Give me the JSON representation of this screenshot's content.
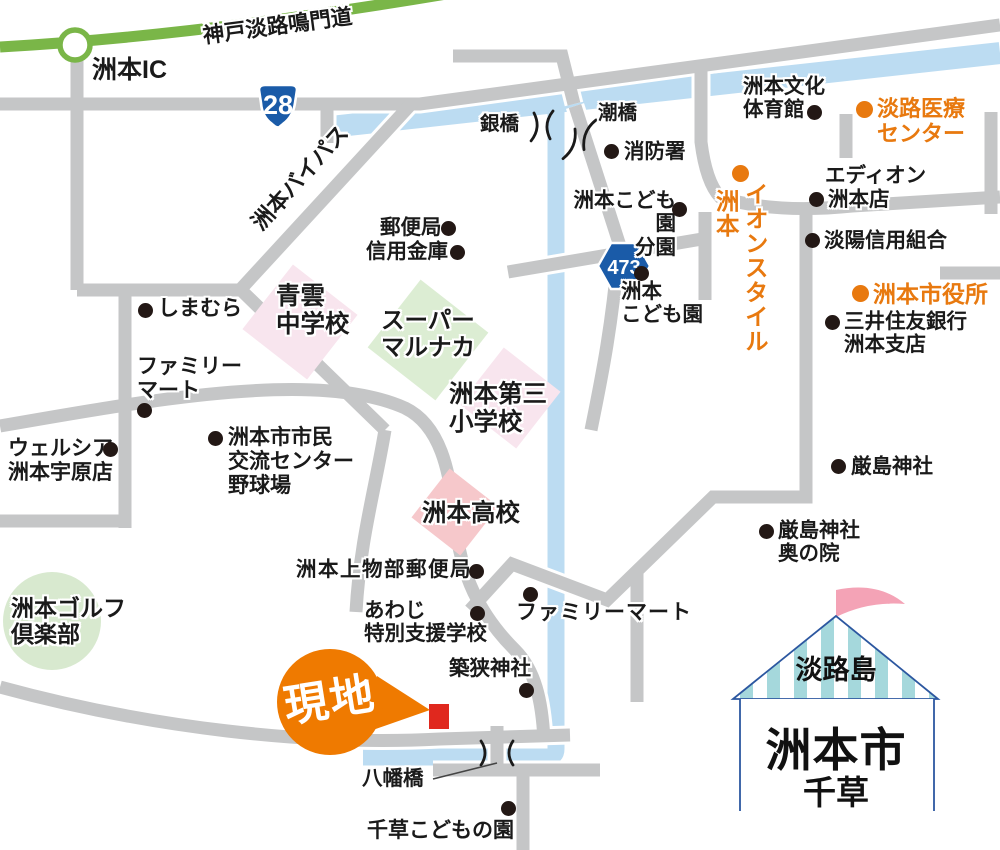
{
  "map_title": "洲本市千草 現地案内図",
  "colors": {
    "road": "#C5C6C7",
    "road_casing": "#FFFFFF",
    "expressway_green": "#7AB648",
    "river_blue": "#BCDCF2",
    "accent_orange": "#E8790F",
    "balloon_orange": "#EF7A00",
    "site_red": "#E0281E",
    "dot_black": "#231815",
    "school_pink": "#F8E5EE",
    "highschool_pink": "#F6C8CB",
    "market_green": "#DCEDD3",
    "golf_green": "#D8E9CF",
    "route_badge_blue": "#1A5BA8",
    "tent_stripe": "#A5D8DC",
    "tent_outline": "#2C57A0",
    "flag_pink": "#F4A3B6"
  },
  "route_badges": [
    {
      "number": "28"
    },
    {
      "number": "473"
    }
  ],
  "site": {
    "balloon": "現地"
  },
  "title_card": {
    "island": "淡路島",
    "city": "洲本市",
    "district": "千草"
  },
  "labels": [
    {
      "name": "sumoto-ic",
      "text": "洲本IC",
      "x": 92,
      "y": 56,
      "size": 25,
      "weight": 800
    },
    {
      "name": "expressway-name",
      "text": "神戸淡路鳴門道",
      "x": 203,
      "y": 24,
      "size": 21.5,
      "weight": 700,
      "rotate": -7.5
    },
    {
      "name": "bypass-name",
      "text": "洲本バイパス",
      "x": 256,
      "y": 214,
      "size": 22,
      "weight": 800,
      "rotate": -48
    },
    {
      "name": "ginbashi-bridge",
      "text": "銀橋",
      "x": 480,
      "y": 113,
      "size": 19.5
    },
    {
      "name": "ushiobashi-bridge",
      "text": "潮橋",
      "x": 598,
      "y": 102,
      "size": 19.5
    },
    {
      "name": "fire-station",
      "text": "消防署",
      "x": 624,
      "y": 140,
      "size": 20.5,
      "dot": {
        "x": 611,
        "y": 151
      }
    },
    {
      "name": "bunka-taiikukan",
      "text": "洲本文化\n体育館",
      "x": 743,
      "y": 75,
      "size": 20.5,
      "dot": {
        "x": 814,
        "y": 112
      }
    },
    {
      "name": "awaji-medical-center",
      "text": "淡路医療\nセンター",
      "x": 877,
      "y": 96,
      "size": 22,
      "weight": 800,
      "color": "#E8790F",
      "dot": {
        "x": 864,
        "y": 109,
        "color": "#E8790F"
      }
    },
    {
      "name": "edion-line1",
      "text": "エディオン",
      "x": 825,
      "y": 164,
      "size": 20.5
    },
    {
      "name": "edion-line2",
      "text": "洲本店",
      "x": 828,
      "y": 188,
      "size": 20.5,
      "dot": {
        "x": 816,
        "y": 199
      }
    },
    {
      "name": "tanyo-shinyokumiai",
      "text": "淡陽信用組合",
      "x": 824,
      "y": 229,
      "size": 20.5,
      "dot": {
        "x": 812,
        "y": 240
      }
    },
    {
      "name": "city-hall",
      "text": "洲本市役所",
      "x": 873,
      "y": 281,
      "size": 23,
      "weight": 800,
      "color": "#E8790F",
      "dot": {
        "x": 860,
        "y": 293,
        "color": "#E8790F"
      }
    },
    {
      "name": "smbc-sumoto",
      "text": "三井住友銀行\n洲本支店",
      "x": 844,
      "y": 310,
      "size": 20.5,
      "dot": {
        "x": 832,
        "y": 322
      }
    },
    {
      "name": "itsukushima-jinja",
      "text": "厳島神社",
      "x": 851,
      "y": 455,
      "size": 20.5,
      "dot": {
        "x": 838,
        "y": 466
      }
    },
    {
      "name": "itsukushima-okunoin",
      "text": "厳島神社\n奥の院",
      "x": 778,
      "y": 519,
      "size": 20.5,
      "dot": {
        "x": 766,
        "y": 531
      }
    },
    {
      "name": "post-office",
      "text": "郵便局",
      "x": 380,
      "y": 216,
      "size": 20.5,
      "dot": {
        "x": 448,
        "y": 228
      }
    },
    {
      "name": "shinyo-kinko",
      "text": "信用金庫",
      "x": 366,
      "y": 240,
      "size": 20.5,
      "dot": {
        "x": 457,
        "y": 252
      }
    },
    {
      "name": "shimamura",
      "text": "しまむら",
      "x": 158,
      "y": 297,
      "size": 21,
      "dot": {
        "x": 145,
        "y": 310
      }
    },
    {
      "name": "familymart-west",
      "text": "ファミリー\nマート",
      "x": 137,
      "y": 355,
      "size": 21,
      "dot": {
        "x": 144,
        "y": 410
      }
    },
    {
      "name": "welcia-uehara",
      "text": "ウェルシア\n洲本宇原店",
      "x": 8,
      "y": 437,
      "size": 21,
      "dot": {
        "x": 110,
        "y": 449
      }
    },
    {
      "name": "shimin-koryu-center",
      "text": "洲本市市民\n交流センター\n野球場",
      "x": 228,
      "y": 426,
      "size": 21,
      "dot": {
        "x": 215,
        "y": 438
      }
    },
    {
      "name": "kodomoen-bunen",
      "text": "洲本こども園\n分園",
      "x": 566,
      "y": 189,
      "size": 20.5,
      "width": 110,
      "align": "right",
      "dot": {
        "x": 679,
        "y": 209
      }
    },
    {
      "name": "sumoto-kodomoen",
      "text": "洲本\nこども園",
      "x": 621,
      "y": 280,
      "size": 20.5,
      "dot": {
        "x": 641,
        "y": 273
      }
    },
    {
      "name": "seiun-chugakko",
      "text": "青雲\n中学校",
      "x": 276,
      "y": 283,
      "size": 24.5,
      "weight": 800
    },
    {
      "name": "super-marunaka",
      "text": "スーパー\nマルナカ",
      "x": 381,
      "y": 307,
      "size": 23.5,
      "weight": 800
    },
    {
      "name": "daisan-shogakko",
      "text": "洲本第三\n小学校",
      "x": 449,
      "y": 381,
      "size": 24.5,
      "weight": 800
    },
    {
      "name": "sumoto-koko",
      "text": "洲本高校",
      "x": 422,
      "y": 500,
      "size": 24.5,
      "weight": 800
    },
    {
      "name": "sumoto-golf-club",
      "text": "洲本ゴルフ\n倶楽部",
      "x": 11,
      "y": 595,
      "size": 23,
      "weight": 800
    },
    {
      "name": "kamimonobe-post",
      "text": "洲本上物部郵便局",
      "x": 296,
      "y": 558,
      "size": 20.5,
      "ls": 1.5,
      "dot": {
        "x": 476,
        "y": 571
      }
    },
    {
      "name": "awaji-tokubetsu",
      "text": "あわじ\n特別支援学校",
      "x": 364,
      "y": 599,
      "size": 20.5,
      "dot": {
        "x": 477,
        "y": 613
      }
    },
    {
      "name": "familymart-south",
      "text": "ファミリーマート",
      "x": 516,
      "y": 601,
      "size": 21,
      "ls": 1,
      "dot": {
        "x": 530,
        "y": 594
      }
    },
    {
      "name": "chikusa-jinja",
      "text": "築狭神社",
      "x": 449,
      "y": 657,
      "size": 20.5,
      "dot": {
        "x": 526,
        "y": 690
      }
    },
    {
      "name": "yahatabashi-bridge",
      "text": "八幡橋",
      "x": 362,
      "y": 767,
      "size": 20.5
    },
    {
      "name": "chigusa-kodomonosono",
      "text": "千草こどもの園",
      "x": 367,
      "y": 819,
      "size": 21,
      "dot": {
        "x": 508,
        "y": 808
      }
    },
    {
      "name": "aeon-style",
      "text": "イオンスタイル",
      "x": 741,
      "y": 182,
      "size": 23.5,
      "weight": 800,
      "color": "#E8790F",
      "vertical": true,
      "dot": {
        "x": 740,
        "y": 173,
        "color": "#E8790F"
      }
    },
    {
      "name": "aeon-style-sumoto",
      "text": "洲本",
      "x": 712,
      "y": 189,
      "size": 23.5,
      "weight": 800,
      "color": "#E8790F",
      "vertical": true
    }
  ]
}
